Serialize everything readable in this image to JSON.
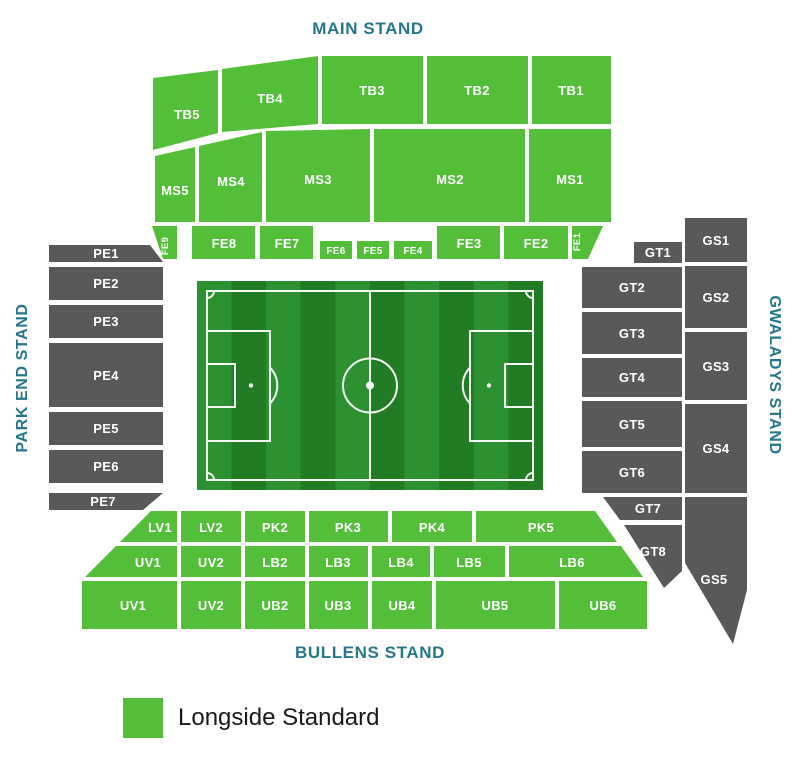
{
  "map": {
    "stands": {
      "main": "MAIN STAND",
      "park_end": "PARK END STAND",
      "gwaladys": "GWALADYS STAND",
      "bullens": "BULLENS STAND"
    },
    "sections": {
      "tb5": "TB5",
      "tb4": "TB4",
      "tb3": "TB3",
      "tb2": "TB2",
      "tb1": "TB1",
      "ms5": "MS5",
      "ms4": "MS4",
      "ms3": "MS3",
      "ms2": "MS2",
      "ms1": "MS1",
      "fe9": "FE9",
      "fe8": "FE8",
      "fe7": "FE7",
      "fe6": "FE6",
      "fe5": "FE5",
      "fe4": "FE4",
      "fe3": "FE3",
      "fe2": "FE2",
      "fe1": "FE1",
      "pe1": "PE1",
      "pe2": "PE2",
      "pe3": "PE3",
      "pe4": "PE4",
      "pe5": "PE5",
      "pe6": "PE6",
      "pe7": "PE7",
      "gt1": "GT1",
      "gt2": "GT2",
      "gt3": "GT3",
      "gt4": "GT4",
      "gt5": "GT5",
      "gt6": "GT6",
      "gt7": "GT7",
      "gt8": "GT8",
      "gs1": "GS1",
      "gs2": "GS2",
      "gs3": "GS3",
      "gs4": "GS4",
      "gs5": "GS5",
      "lv1": "LV1",
      "lv2": "LV2",
      "pk2": "PK2",
      "pk3": "PK3",
      "pk4": "PK4",
      "pk5": "PK5",
      "uv1_upper": "UV1",
      "uv2_upper": "UV2",
      "lb2": "LB2",
      "lb3": "LB3",
      "lb4": "LB4",
      "lb5": "LB5",
      "lb6": "LB6",
      "uv1_lower": "UV1",
      "uv2_lower": "UV2",
      "ub2": "UB2",
      "ub3": "UB3",
      "ub4": "UB4",
      "ub5": "UB5",
      "ub6": "UB6"
    }
  },
  "legend": {
    "items": [
      {
        "label": "Longside Standard",
        "color": "#53bf38"
      }
    ]
  },
  "colors": {
    "longside": "#53bf38",
    "unavailable": "#58595b",
    "stand_label": "#24788a",
    "pitch_dark": "#217c24",
    "pitch_light": "#2c9130"
  }
}
